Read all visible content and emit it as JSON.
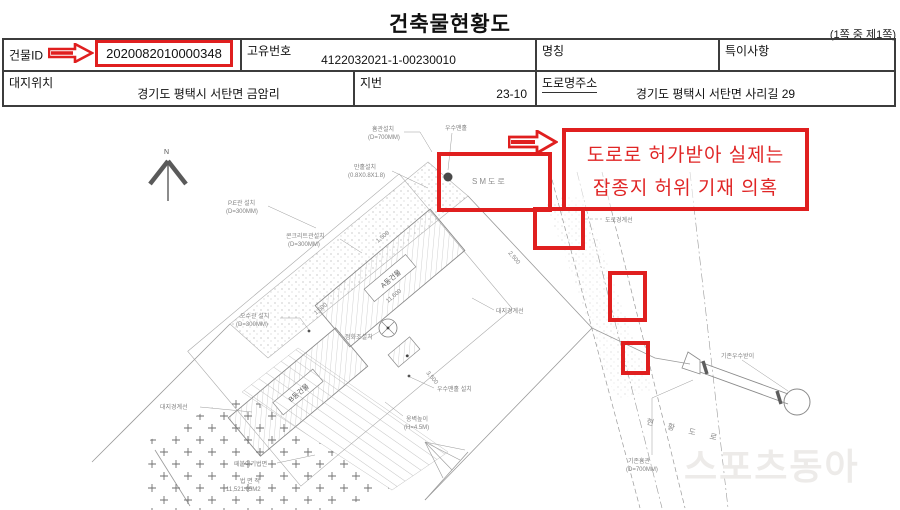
{
  "title": "건축물현황도",
  "page_note": "(1쪽 중 제1쪽)",
  "table": {
    "row1": {
      "building_id_label": "건물ID",
      "building_id_value": "2020082010000348",
      "unique_no_label": "고유번호",
      "unique_no_value": "4122032021-1-00230010",
      "name_label": "명칭",
      "name_value": "",
      "remarks_label": "특이사항",
      "remarks_value": ""
    },
    "row2": {
      "site_location_label": "대지위치",
      "site_location_value": "경기도 평택시 서탄면 금암리",
      "jibun_label": "지번",
      "jibun_value": "23-10",
      "road_address_label": "도로명주소",
      "road_address_value": "경기도 평택시 서탄면 사리길 29"
    }
  },
  "annotation": {
    "line1": "도로로 허가받아 실제는",
    "line2": "잡종지 허위 기재 의혹",
    "accent_color": "#e01f1f"
  },
  "watermark": "스포츠동아",
  "drawing": {
    "labels": {
      "north": "N",
      "sm_road": "SM도로",
      "hume_install": "흄관설치",
      "hume_d": "(D=700MM)",
      "storm_manhole_top": "우수맨홀",
      "manhole_install": "만홀설치",
      "manhole_size": "(0.8X0.8X1.8)",
      "pe_pipe": "P.E관 설치",
      "pe_d": "(D=300MM)",
      "conc_pipe": "콘크리트관설치",
      "conc_d": "(D=300MM)",
      "sewer_pipe": "오수관 설치",
      "sewer_d": "(D=300MM)",
      "septic": "정화조설치",
      "bldg_a": "A동건물",
      "bldg_b": "B동건물",
      "boundary_left": "대지경계선",
      "boundary_right": "대지경계선",
      "road_boundary": "도로경계선",
      "slope": "떼붙이기법면",
      "area_label": "법 면 적",
      "area_value": "11,521.05M2",
      "storm_manhole_install": "우수맨홀 설치",
      "wall_h": "옹벽높이",
      "wall_h_v": "(H=4.5M)",
      "exist_road": "현 황 도 로",
      "exist_hume": "기존흄관",
      "exist_hume_d": "(D=700MM)",
      "exist_inlet": "기존우수받이"
    },
    "dims": {
      "d1": "1,500",
      "d2": "11,600",
      "d3": "1,500",
      "d4": "2,500",
      "d5": "3,500"
    }
  }
}
